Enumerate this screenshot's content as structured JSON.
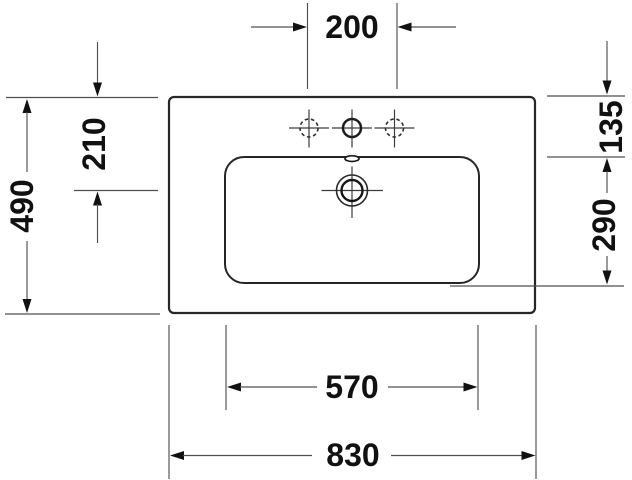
{
  "drawing": {
    "subject": "washbasin-top-view-dimension-drawing",
    "unit": "mm",
    "colors": {
      "background": "#ffffff",
      "ink": "#111111",
      "outline": "#262626",
      "dimension_lines": "#4f4f4f"
    },
    "dims": {
      "top_center": "200",
      "inner_left": "210",
      "overall_left": "490",
      "right_top": "135",
      "right_mid": "290",
      "inner_bottom": "570",
      "overall_bottom": "830"
    }
  }
}
